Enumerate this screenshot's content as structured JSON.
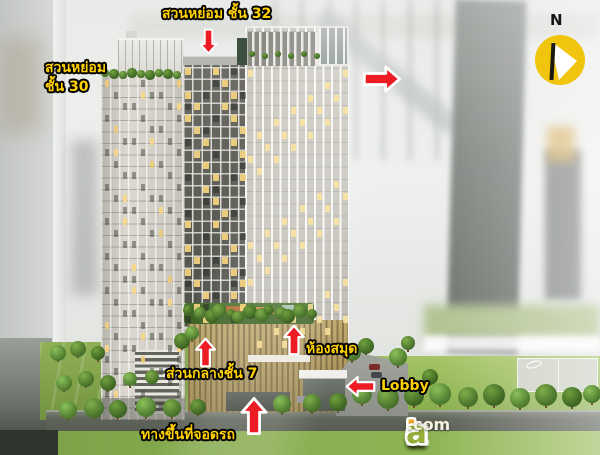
{
  "annotations": {
    "garden_floor_32": {
      "text": "สวนหย่อม ชั้น 32"
    },
    "garden_floor_30": {
      "line1": "สวนหย่อม",
      "line2": "ชั้น 30"
    },
    "common_area_floor_7": {
      "text": "ส่วนกลางชั้น 7"
    },
    "library": {
      "text": "ห้องสมุด"
    },
    "lobby": {
      "text": "Lobby"
    },
    "parking_ramp": {
      "text": "ทางขึ้นที่จอดรถ"
    },
    "label_color": "#ffd103",
    "arrow_color": "#ed1c24"
  },
  "compass": {
    "letter": "N",
    "disc_color": "#f1c40e"
  },
  "watermark": {
    "word": "checkraka",
    "suffix": ".com",
    "letter_colors": [
      "#7da33b",
      "#88a83c",
      "#93ad3d",
      "#e98f27",
      "#7da33b",
      "#e2762a",
      "#8aaa3c",
      "#eda229",
      "#97ad3a"
    ]
  }
}
